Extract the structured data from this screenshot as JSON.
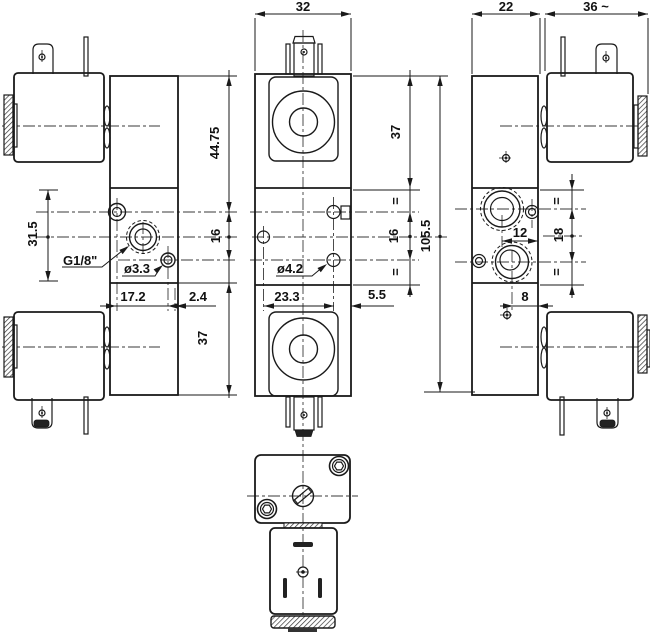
{
  "drawing": {
    "type": "technical-dimension-drawing",
    "subject": "pneumatic-solenoid-valve-three-views-and-bottom-view",
    "colors": {
      "line": "#1a1a1a",
      "background": "#ffffff",
      "text": "#111111"
    },
    "top_dimensions": {
      "front_width": "32",
      "body_width": "22",
      "solenoid_width": "36 ~"
    },
    "left_view": {
      "height_top": "44.75",
      "port_spacing": "16",
      "height_bottom": "37",
      "section_height": "31.5",
      "port_thread": "G1/8\"",
      "pilot_hole": "ø3.3",
      "port_offset": "17.2",
      "edge_offset": "2.4"
    },
    "front_view": {
      "solenoid_height": "37",
      "equal_top": "=",
      "port_spacing": "16",
      "equal_bottom": "=",
      "hole_spacing": "23.3",
      "edge_offset": "5.5",
      "mount_hole": "ø4.2",
      "overall_height": "105.5"
    },
    "right_view": {
      "equal_top": "=",
      "port_spacing": "18",
      "equal_bottom": "=",
      "port_offset_upper": "12",
      "port_offset_lower": "8"
    }
  }
}
